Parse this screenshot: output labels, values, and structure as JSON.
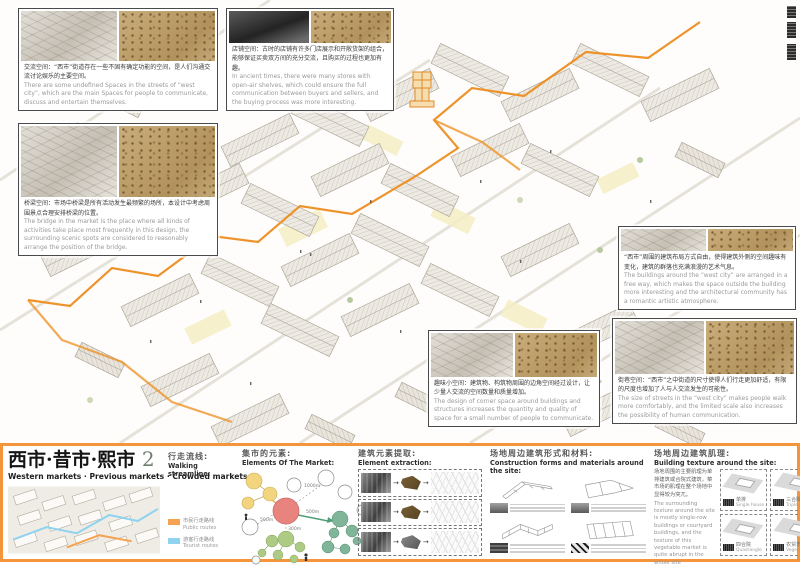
{
  "colors": {
    "frame_orange": "#F5953B",
    "route_highlight_orange": "#EE8E20",
    "public_route": "#F5A353",
    "tourist_route": "#8FD3F0",
    "bubble_center_pink": "#E8837E",
    "bubble_yellow": "#F2D57E",
    "bubble_green": "#AECB86",
    "bubble_teal": "#7FB598"
  },
  "annotations": [
    {
      "id": "communication-space",
      "zh": "交流空间：“西市”街道存在一些不固有确定功能的空间，是人们沟通交流讨论娱乐的主要空间。",
      "en": "There are some undefined Spaces in the streets of “west city”, which are the main Spaces for people to communicate, discuss and entertain themselves."
    },
    {
      "id": "shop-space",
      "zh": "店铺空间：古时的店铺有许多门店展示和开敞货架的组合，能够保证买卖双方间的充分交流，且购买的过程也更加有趣。",
      "en": "In ancient times, there were many stores with open-air shelves, which could ensure the full communication between buyers and sellers, and the buying process was more interesting."
    },
    {
      "id": "bridge-space",
      "zh": "桥梁空间：市场中桥梁是所有活动发生最频繁的场所，本设计中考虑周围景点合理安排桥梁的位置。",
      "en": "The bridge in the market is the place where all kinds of activities take place most frequently in this design, the surrounding scenic spots are considered to reasonably arrange the position of the bridge."
    },
    {
      "id": "building-layout",
      "zh": "“西市”周围的建筑布局方式自由，使得建筑外侧的空间趣味有变化，建筑的群落也充满浪漫的艺术气息。",
      "en": "The buildings around the “west city” are arranged in a free way, which makes the space outside the building more interesting and the architectural community has a romantic artistic atmosphere."
    },
    {
      "id": "street-scale",
      "zh": "街巷空间：“西市”之中街道的尺寸使得人们行走更加舒适，有限的尺度也增加了人与人交流发生的可能性。",
      "en": "The size of streets in the “west city” makes people walk more comfortably, and the limited scale also increases the possibility of human communication."
    },
    {
      "id": "corner-space",
      "zh": "趣味小空间：建筑物、构筑物周围的边角空间经过设计，让少量人交流的空间数量和质量增加。",
      "en": "The design of corner space around buildings and structures increases the quantity and quality of space for a small number of people to communicate."
    }
  ],
  "footer": {
    "title_zh": "西市·昔市·熙市",
    "title_num": "2",
    "subtitle": "Western markets · Previous markets · Crowded markets",
    "streamline": {
      "zh": "行走流线:",
      "en": "Walking streamline:",
      "legend": [
        {
          "zh": "市民行走路线",
          "en": "Public routes",
          "color": "#F5A353"
        },
        {
          "zh": "游客行走路线",
          "en": "Tourist routes",
          "color": "#8FD3F0"
        }
      ]
    },
    "sections": {
      "elements": {
        "zh": "集市的元素:",
        "en": "Elements Of The Market:"
      },
      "extraction": {
        "zh": "建筑元素提取:",
        "en": "Element extraction:"
      },
      "construction": {
        "zh": "场地周边建筑形式和材料:",
        "en": "Construction forms and materials around the site:"
      },
      "texture": {
        "zh": "场地周边建筑肌理:",
        "en": "Building texture around the site:"
      }
    },
    "bubble": {
      "distances": [
        "500m",
        "1000m",
        "300m",
        "500m"
      ]
    },
    "texture_note": {
      "zh": "场地周围的主要肌理为单排建筑或合院式建筑，菜市场的肌理在整个场地中显得较为突兀。",
      "en": "The surrounding texture around the site is mostly single-row buildings or courtyard buildings, and the texture of this vegetable market is quite abrupt in the whole site"
    },
    "texture_cards": [
      {
        "zh": "单排",
        "en": "Single house"
      },
      {
        "zh": "三合院",
        "en": "Triple courtyard"
      },
      {
        "zh": "四合院",
        "en": "Quadrangle"
      },
      {
        "zh": "农贸市场",
        "en": "Vegetable market"
      }
    ]
  }
}
